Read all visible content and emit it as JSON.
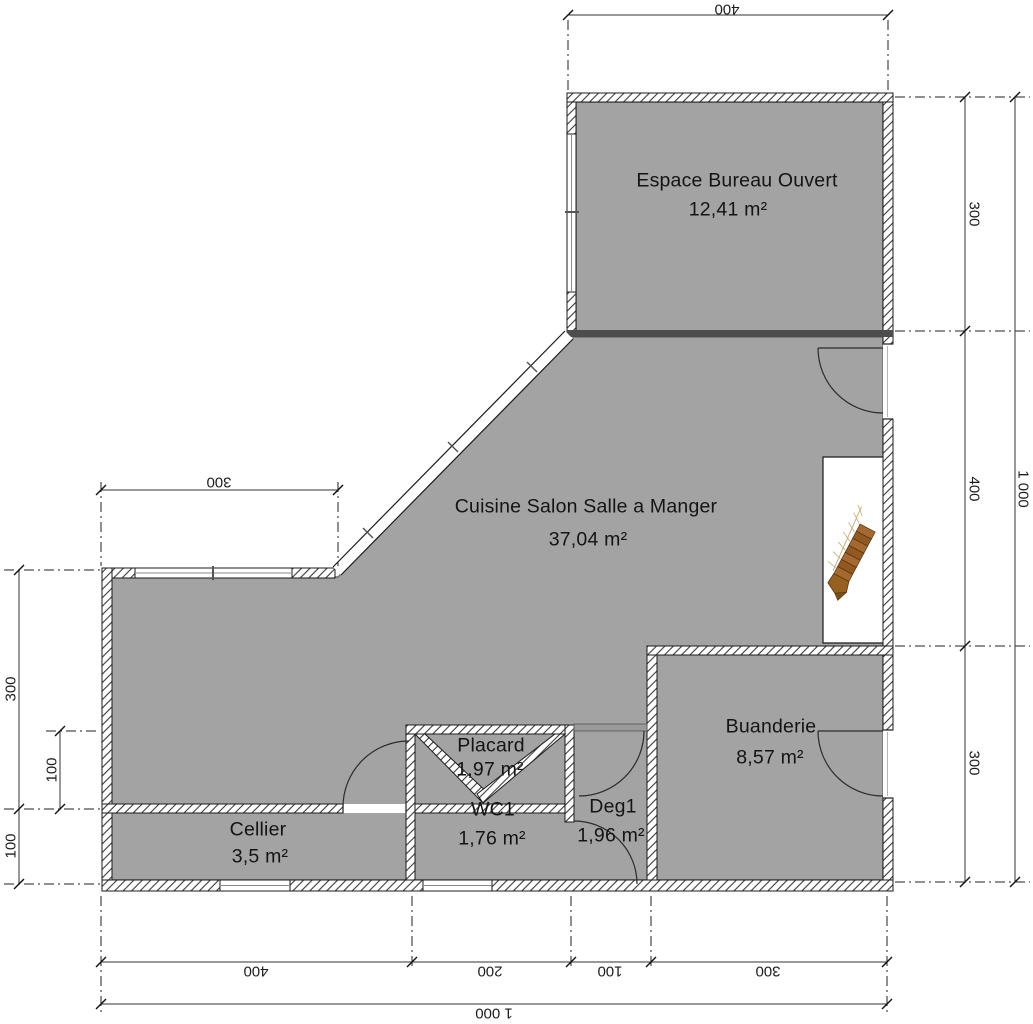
{
  "plan": {
    "rooms": [
      {
        "id": "espace-bureau",
        "name": "Espace Bureau Ouvert",
        "area": "12,41 m²"
      },
      {
        "id": "cuisine",
        "name": "Cuisine Salon Salle a Manger",
        "area": "37,04 m²"
      },
      {
        "id": "placard",
        "name": "Placard",
        "area": "1,97 m²"
      },
      {
        "id": "wc1",
        "name": "WC1",
        "area": "1,76 m²"
      },
      {
        "id": "deg1",
        "name": "Deg1",
        "area": "1,96 m²"
      },
      {
        "id": "cellier",
        "name": "Cellier",
        "area": "3,5 m²"
      },
      {
        "id": "buanderie",
        "name": "Buanderie",
        "area": "8,57 m²"
      }
    ],
    "dimensions": {
      "top_width": "400",
      "wing_top_width": "300",
      "left": {
        "upper": "300",
        "inner": "100",
        "lower": "100"
      },
      "right": {
        "upper": "300",
        "middle": "400",
        "lower": "300",
        "total": "1 000"
      },
      "bottom": {
        "d1": "400",
        "d2": "200",
        "d3": "100",
        "d4": "300",
        "total": "1 000"
      }
    },
    "icons": [
      {
        "name": "staircase-icon",
        "description": "winder staircase in stairwell niche"
      }
    ],
    "colors": {
      "floor": "#a3a3a3",
      "wall_outline": "#1b1b1b",
      "room_separator": "#4d4d4d",
      "stair_wood": "#a0662e",
      "background": "#ffffff"
    }
  }
}
